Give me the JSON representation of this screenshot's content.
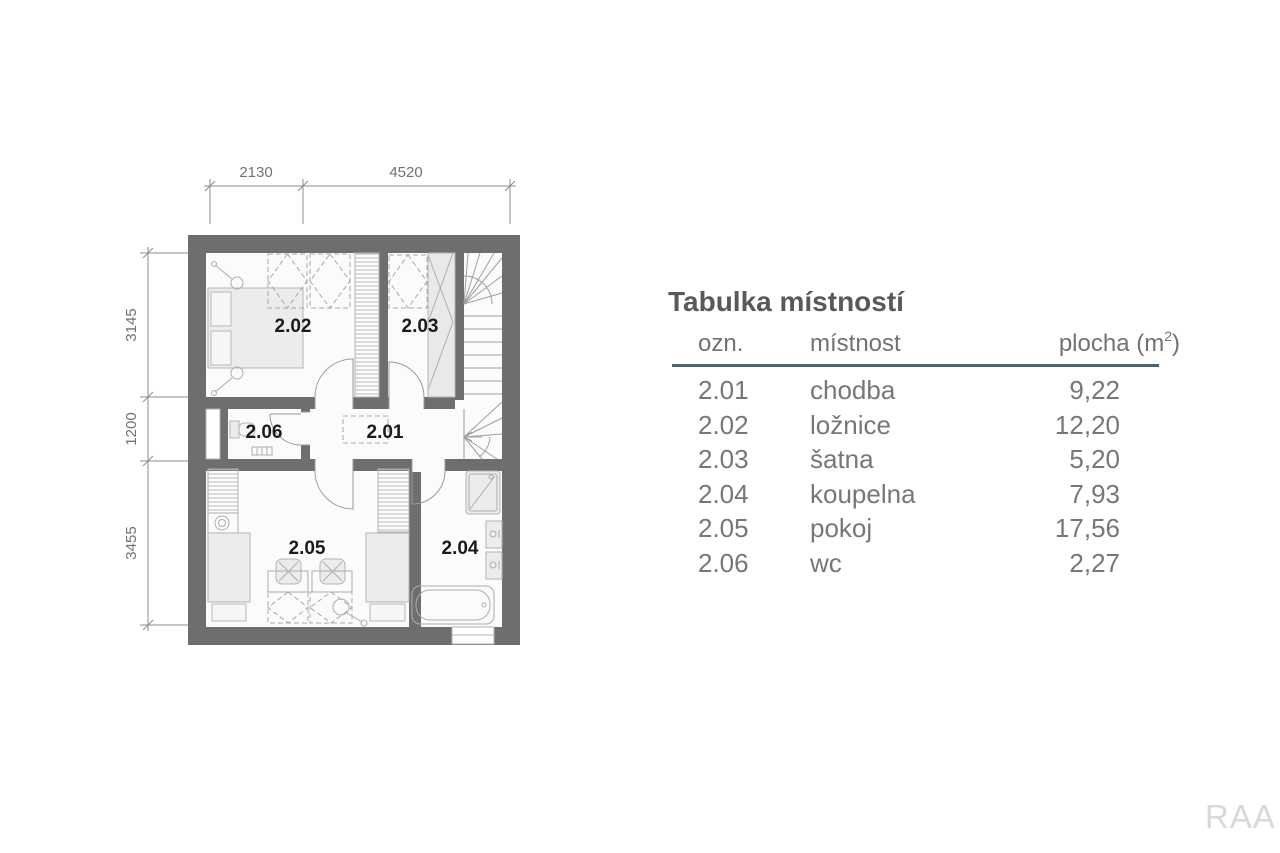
{
  "plan": {
    "dims_top": {
      "d1": "2130",
      "d2": "4520"
    },
    "dims_left": {
      "d1": "3145",
      "d2": "1200",
      "d3": "3455"
    },
    "labels": {
      "r201": "2.01",
      "r202": "2.02",
      "r203": "2.03",
      "r204": "2.04",
      "r205": "2.05",
      "r206": "2.06"
    }
  },
  "table": {
    "title": "Tabulka místností",
    "headers": {
      "ozn": "ozn.",
      "mistnost": "místnost",
      "plocha_prefix": "plocha (m",
      "plocha_sup": "2",
      "plocha_suffix": ")"
    },
    "rows": [
      {
        "ozn": "2.01",
        "mistnost": "chodba",
        "plocha": "9,22"
      },
      {
        "ozn": "2.02",
        "mistnost": "ložnice",
        "plocha": "12,20"
      },
      {
        "ozn": "2.03",
        "mistnost": "šatna",
        "plocha": "5,20"
      },
      {
        "ozn": "2.04",
        "mistnost": "koupelna",
        "plocha": "7,93"
      },
      {
        "ozn": "2.05",
        "mistnost": "pokoj",
        "plocha": "17,56"
      },
      {
        "ozn": "2.06",
        "mistnost": "wc",
        "plocha": "2,27"
      }
    ]
  },
  "watermark": "RAA",
  "colors": {
    "wall": "#6e6e6e",
    "floor": "#fbfbfb",
    "rule": "#4a6674",
    "table_text": "#75777a",
    "title_text": "#58595b",
    "room_label_text": "#1a1a1a",
    "dim_text": "#707274",
    "watermark_text": "#d7d8dc"
  }
}
